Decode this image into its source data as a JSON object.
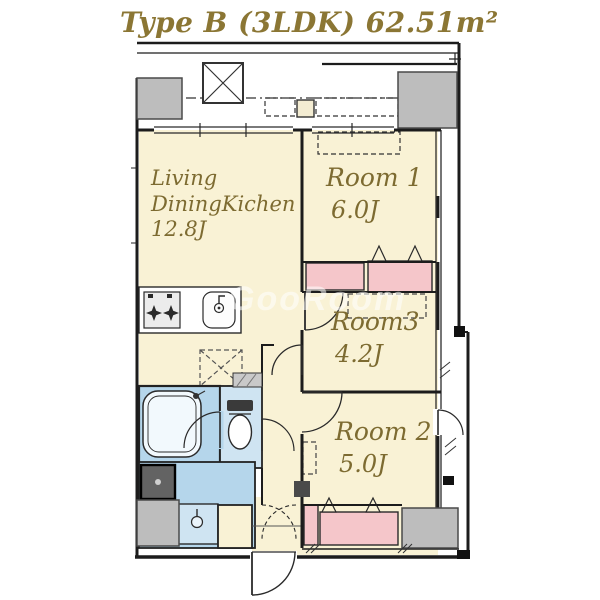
{
  "title": "Type B (3LDK) 62.51m²",
  "watermark": "GooRoom",
  "rooms": {
    "ldk": {
      "line1": "Living",
      "line2": "DiningKichen",
      "size": "12.8J"
    },
    "room1": {
      "name": "Room 1",
      "size": "6.0J"
    },
    "room3": {
      "name": "Room3",
      "size": "4.2J"
    },
    "room2": {
      "name": "Room 2",
      "size": "5.0J"
    }
  },
  "icons": {
    "escape_hatch": "crossed-square",
    "stove": "two-burner-stove",
    "sink": "basin-with-faucet",
    "bathtub": "tub",
    "toilet": "wc",
    "washbasin": "basin-faucet",
    "washer_pan": "washer-pan",
    "underfloor_hatch": "dashed-crossed-square"
  },
  "legend_colors": {
    "room_floor": "#f9f2d5",
    "closet": "#f5c6ca",
    "wet_area": "#b5d6eb",
    "toilet_area": "#cfe4f2",
    "column": "#bdbdbd",
    "wall": "#1c1c1c",
    "text_gold": "#836f35"
  }
}
